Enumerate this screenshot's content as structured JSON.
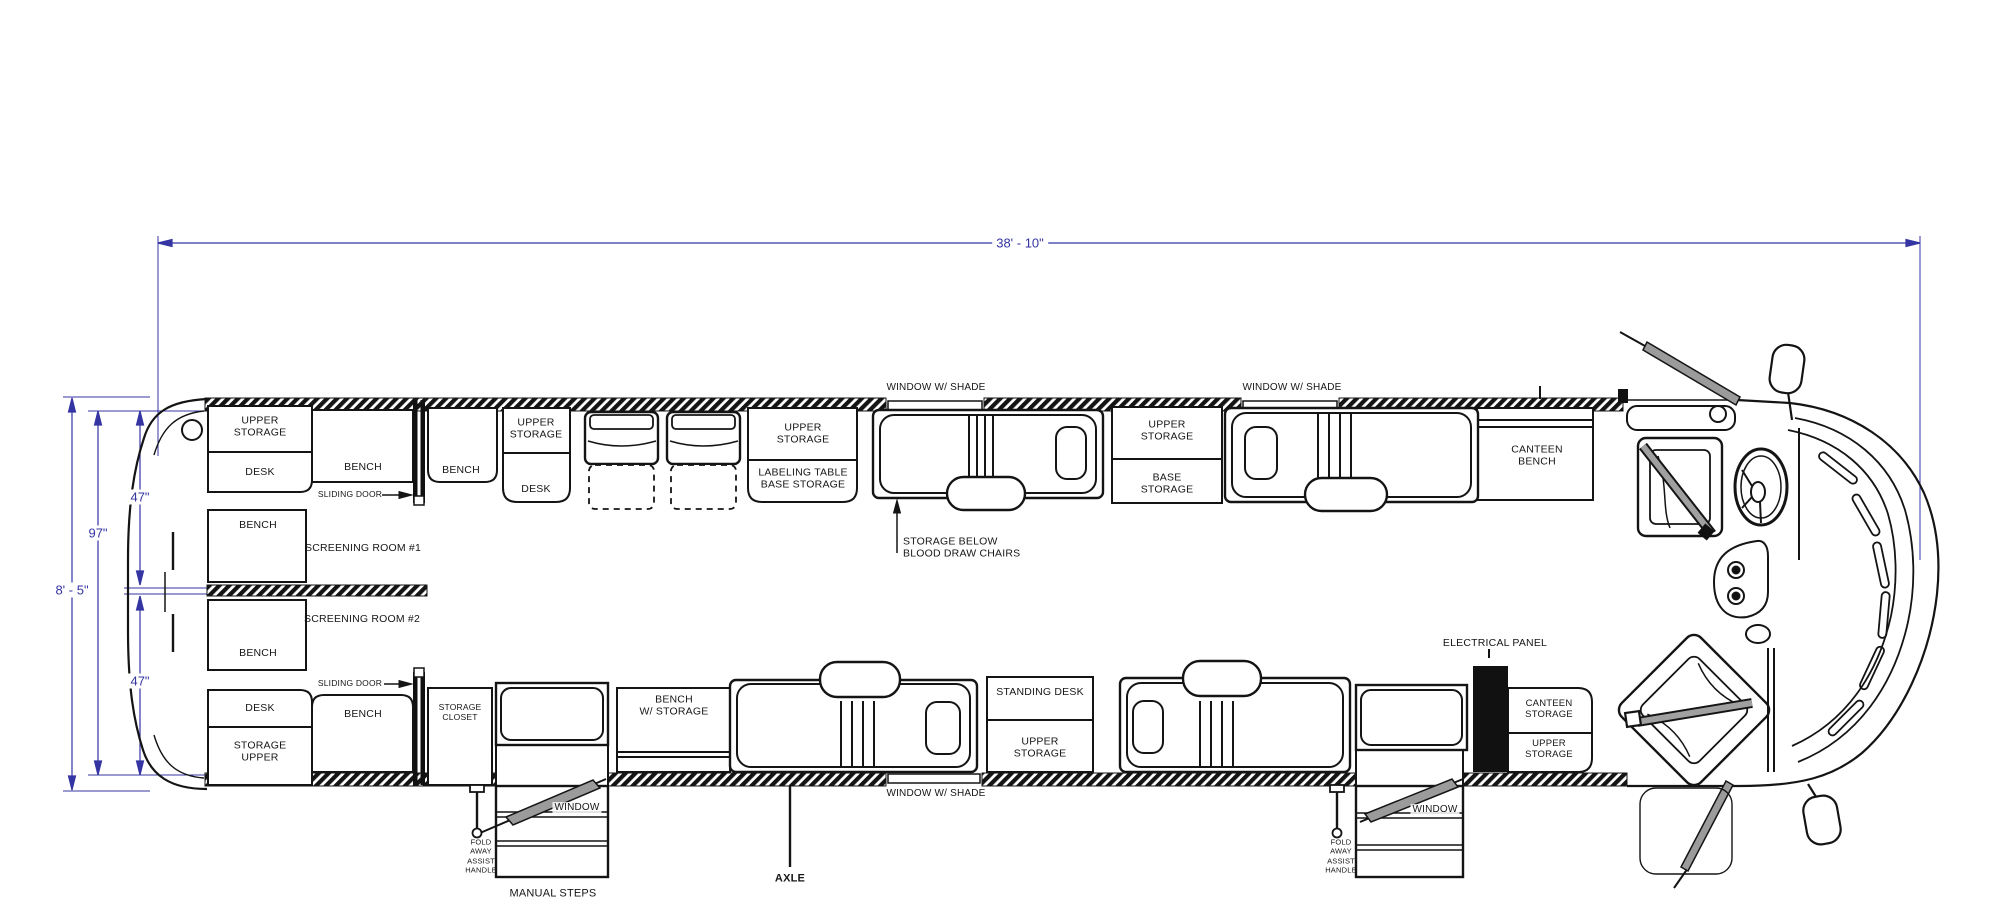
{
  "drawing": {
    "type": "bus-floor-plan",
    "vehicle": "specialty coach / bloodmobile"
  },
  "colors": {
    "dimension_blue": "#3434a3",
    "line_black": "#141414",
    "door_gray": "#9b9b9b",
    "panel_black": "#111111"
  },
  "dims": {
    "overall_length": "38' - 10\"",
    "overall_width": "8' - 5\"",
    "interior_width": "97\"",
    "screening_top": "47\"",
    "screening_bottom": "47\""
  },
  "labels": {
    "rear_upper_storage": "UPPER\nSTORAGE",
    "rear_desk": "DESK",
    "bench_top_1": "BENCH",
    "sliding_door_top": "SLIDING DOOR",
    "bench_top_2": "BENCH",
    "mid_upper_storage": "UPPER\nSTORAGE",
    "mid_desk": "DESK",
    "label_table_upper": "UPPER\nSTORAGE",
    "labeling_table": "LABELING TABLE\nBASE STORAGE",
    "window_shade_top_1": "WINDOW W/ SHADE",
    "storage_below_chairs": "STORAGE BELOW\nBLOOD DRAW CHAIRS",
    "station2_upper": "UPPER\nSTORAGE",
    "station2_base": "BASE\nSTORAGE",
    "window_shade_top_2": "WINDOW W/ SHADE",
    "canteen_bench": "CANTEEN\nBENCH",
    "bench_sr1": "BENCH",
    "screening_room_1": "SCREENING ROOM #1",
    "screening_room_2": "SCREENING ROOM #2",
    "bench_sr2": "BENCH",
    "desk_bottom": "DESK",
    "storage_upper_rear": "STORAGE\nUPPER",
    "sliding_door_bottom": "SLIDING DOOR",
    "bench_bottom": "BENCH",
    "storage_closet": "STORAGE\nCLOSET",
    "window_steps_1": "WINDOW",
    "fold_away_1": "FOLD\nAWAY\nASSIST\nHANDLE",
    "manual_steps": "MANUAL STEPS",
    "bench_w_storage": "BENCH\nW/ STORAGE",
    "window_shade_bottom": "WINDOW W/ SHADE",
    "axle": "AXLE",
    "standing_desk": "STANDING DESK",
    "standing_upper_storage": "UPPER\nSTORAGE",
    "electrical_panel": "ELECTRICAL PANEL",
    "canteen_storage": "CANTEEN\nSTORAGE",
    "canteen_upper_storage": "UPPER\nSTORAGE",
    "window_steps_2": "WINDOW",
    "fold_away_2": "FOLD\nAWAY\nASSIST\nHANDLE"
  }
}
